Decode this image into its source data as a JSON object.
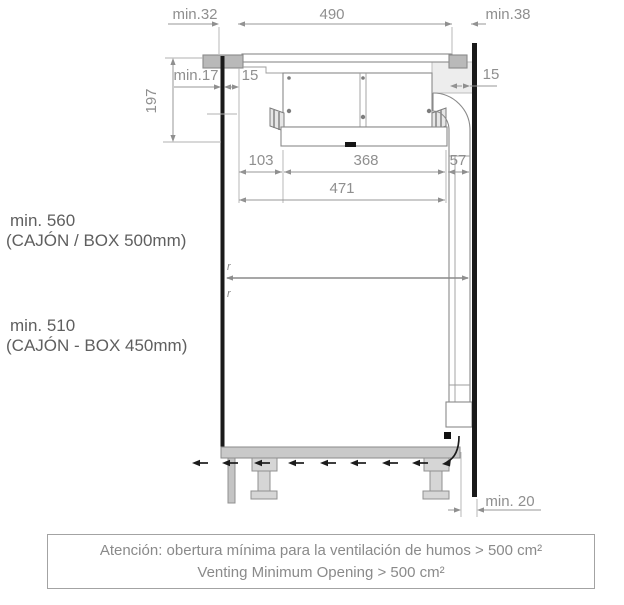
{
  "colors": {
    "structure_black": "#1a1a1a",
    "dimension_gray": "#8f8f8f",
    "counter_fill": "#b9b9b9",
    "light_fill": "#ededed"
  },
  "dimensions": {
    "top_left_clearance": "min.32",
    "cutout_width": "490",
    "top_right_clearance": "min.38",
    "panel_offset": "min.17",
    "left_gap": "15",
    "right_gap": "15",
    "unit_depth": "197",
    "front_offset": "103",
    "body_width": "368",
    "duct_width": "57",
    "total_width": "471",
    "bottom_rear_gap": "min. 20",
    "radius_mark_top": "r",
    "radius_mark_bottom": "r"
  },
  "cabinet_labels": {
    "upper_height": "min. 560",
    "upper_note": "(CAJÓN / BOX 500mm)",
    "lower_height": "min. 510",
    "lower_note": "(CAJÓN -  BOX 450mm)"
  },
  "attention_note": {
    "line1": "Atención: obertura mínima para la ventilación de humos > 500 cm²",
    "line2": "Venting Minimum Opening > 500 cm²"
  }
}
